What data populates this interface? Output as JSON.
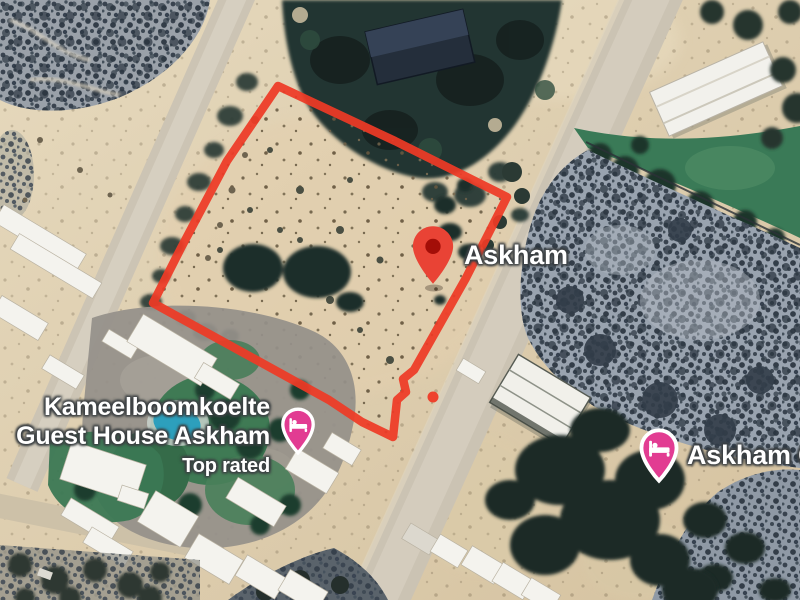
{
  "map": {
    "town_label": "Askham",
    "place_label_right": "Askham G",
    "guesthouse_label": {
      "line1": "Kameelboomkoelte",
      "line2": "Guest House Askham",
      "badge": "Top rated"
    }
  },
  "colors": {
    "parcel_red": "#EE3A26",
    "marker_red": "#E94335",
    "marker_red_core": "#A30E08",
    "lodging_pink": "#E23C92",
    "label_white": "#FFFFFF",
    "label_halo": "#3C4043"
  },
  "icons": {
    "red_marker": "red-map-pin-icon",
    "lodging": "lodging-bed-icon"
  }
}
